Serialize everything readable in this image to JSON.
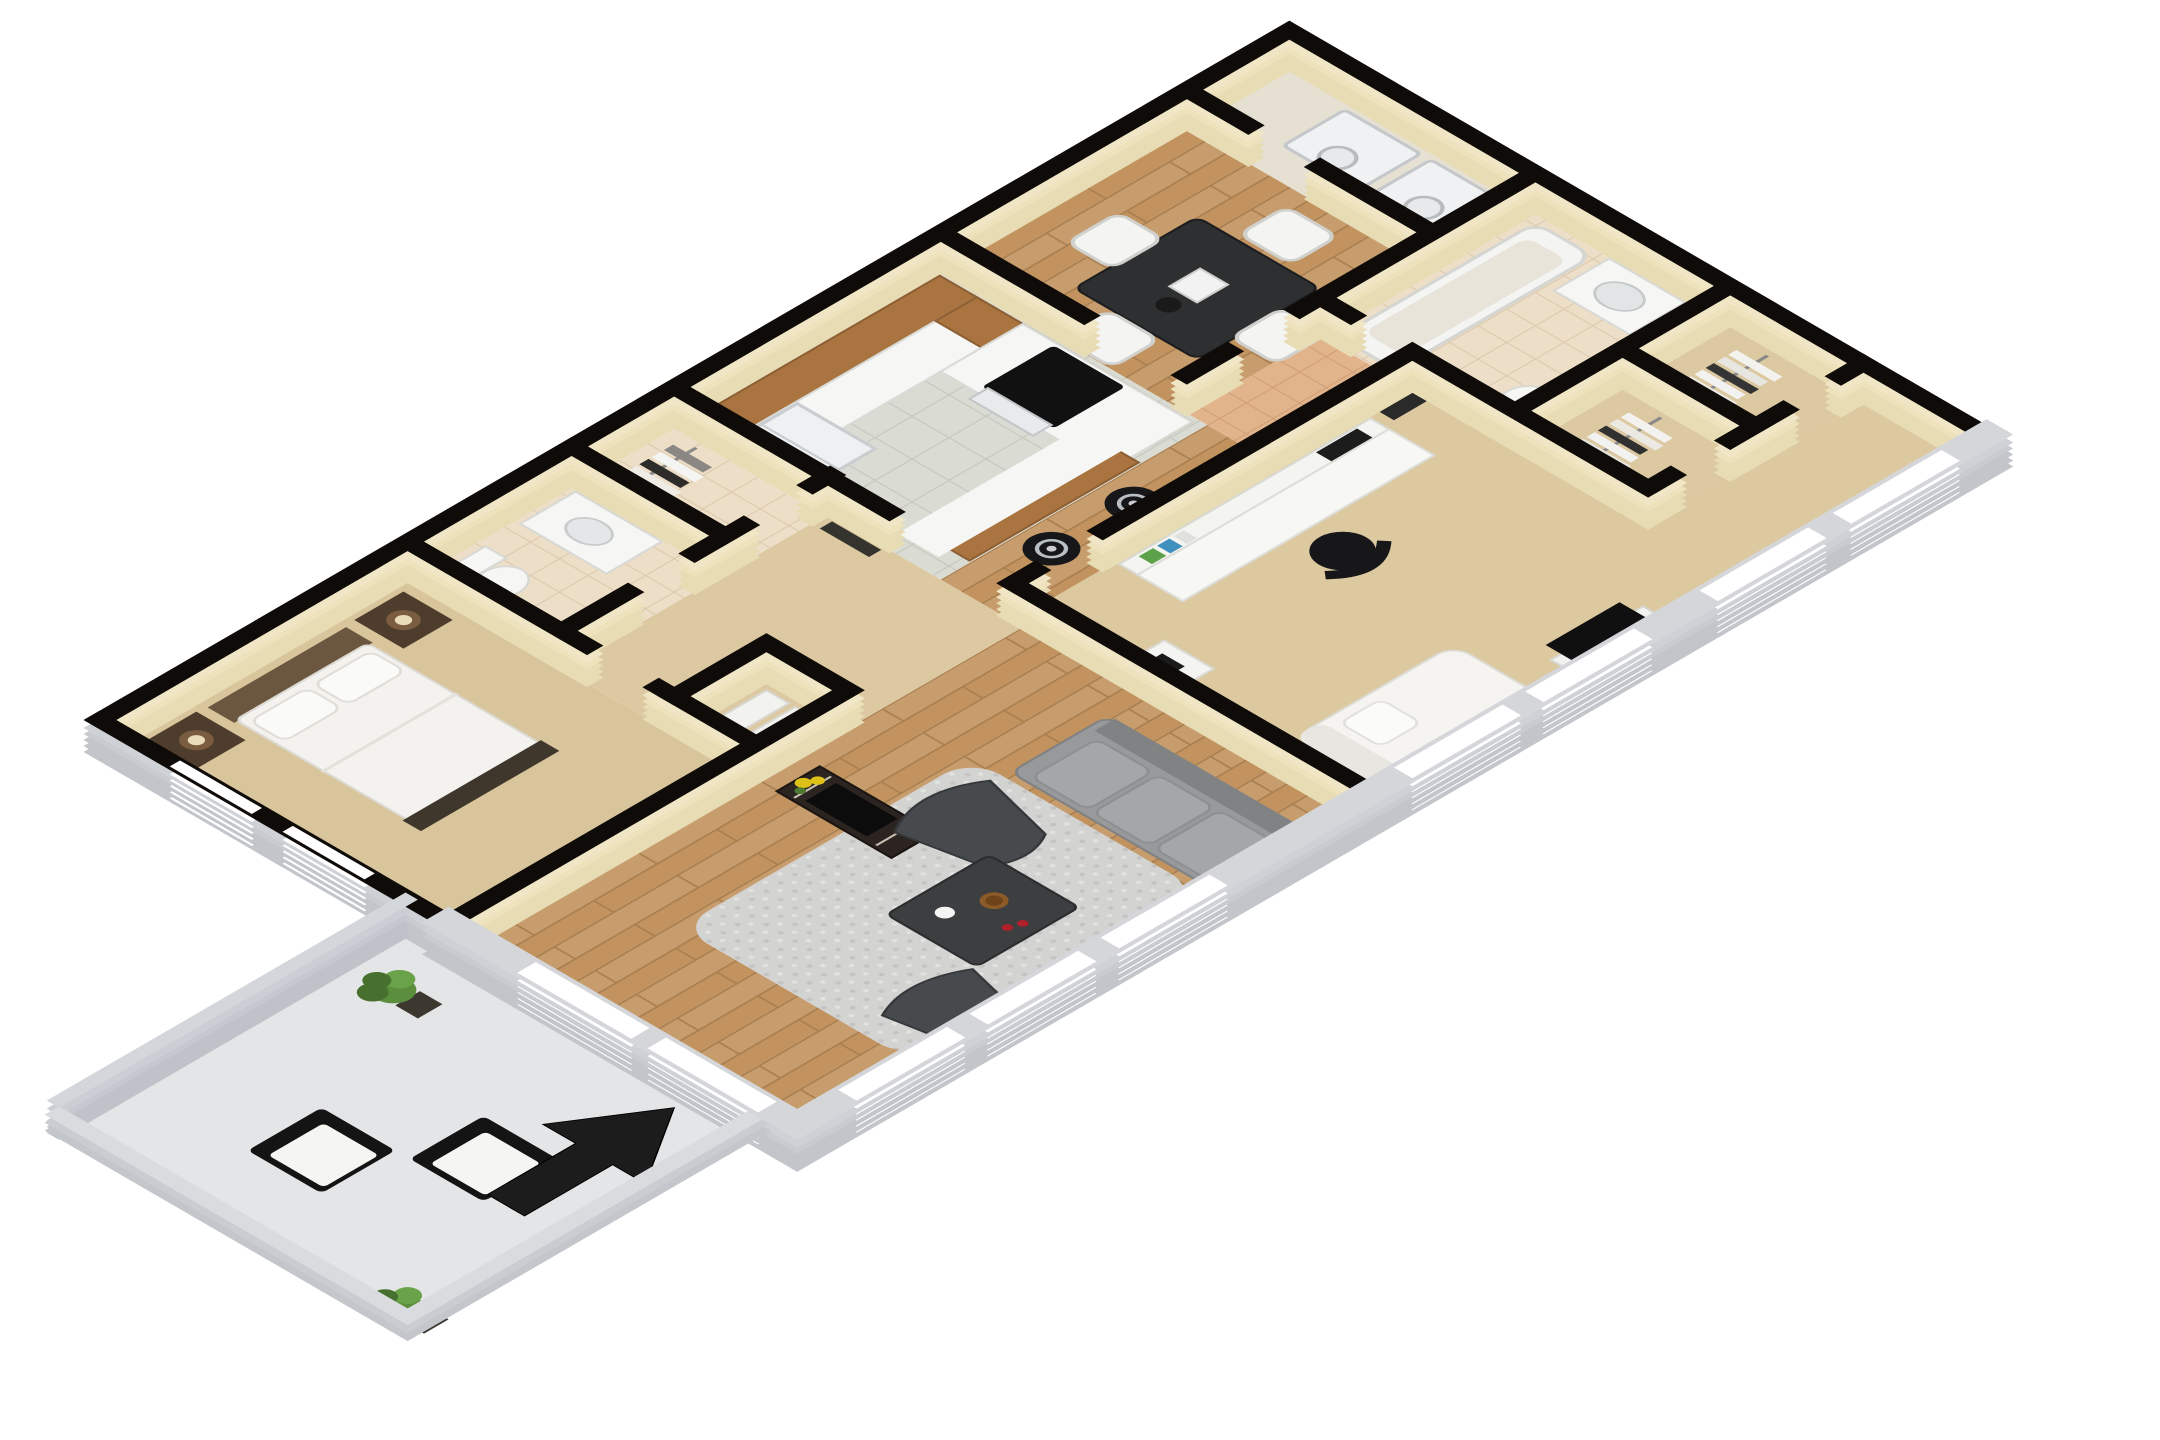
{
  "page": {
    "background": "#ffffff",
    "description": "3D isometric cutaway floor plan rendering of a two-bedroom, two-bathroom apartment with balcony, shown on a white background with thick black wall outlines",
    "visible_text": []
  },
  "palette": {
    "wall_cap": "#0e0b08",
    "wall_face": "#e7dcb4",
    "wall_face_light": "#f0e6c6",
    "exterior_cap": "#d4d6da",
    "exterior_face": "#c2c5ca",
    "parapet_cap": "#d9dbde",
    "parapet_face": "#c3c6cb",
    "privacy_cap": "#d3d6da",
    "carpet_master": "#d8c59b",
    "carpet_bedroom2": "#dcc9a0",
    "carpet_hall": "#dcc9a2",
    "wood_floor": "#c79d6e",
    "wood_line": "#a97f4f",
    "kitchen_tile": "#dadcd4",
    "kitchen_grout": "#c7cac1",
    "bath_tile": "#eddec7",
    "bath_grout": "#dcc9ad",
    "hall_tile": "#e2b48c",
    "hall_grout": "#cf9f77",
    "laundry_tile": "#e6e0d2",
    "patio_floor": "#e4e5e7",
    "rug": "#d3d3d1",
    "rug_dot_dark": "#c3c3c1",
    "rug_dot_light": "#e2e2e0",
    "sofa": "#97999b",
    "sofa_back": "#808284",
    "accent_chair": "#474a4c",
    "coffee_table": "#3c3e40",
    "black_furniture": "#17171a",
    "white_furniture": "#f5f5f2",
    "cabinet_wood": "#a9743f",
    "counter": "#f6f6f4",
    "appliance": "#eef0f1",
    "headboard": "#6b5640",
    "nightstand_dark": "#4e3c2c",
    "plant": "#5b8f3e",
    "plant_dark": "#47702e",
    "pot": "#3c3830",
    "arrow": "#1c1c1c",
    "window_frame": "#ffffff",
    "linen": "#f3f2ef",
    "decor_red": "#b0202a",
    "decor_yellow": "#ddc018",
    "book_green": "#5da24a",
    "book_blue": "#3f8fbf"
  },
  "projection": {
    "type": "isometric 3D cutaway",
    "rotate_deg": -45,
    "vertical_scale": 0.58,
    "wall_height_px": 38,
    "scale": 1.45
  },
  "rooms": [
    {
      "name": "Master Bedroom",
      "floor": "tan carpet",
      "furniture": [
        "double bed with white linens",
        "dark headboard",
        "two dark wood nightstands",
        "two table lamps",
        "framed artwork above headboard",
        "two windows on west wall",
        "closet with white shelves"
      ]
    },
    {
      "name": "Master Bathroom",
      "floor": "beige tile",
      "furniture": [
        "toilet",
        "white vanity with sink"
      ]
    },
    {
      "name": "Master Closet",
      "floor": "beige tile",
      "furniture": [
        "clothes rail with hanging clothes"
      ]
    },
    {
      "name": "Kitchen",
      "floor": "gray tile",
      "furniture": [
        "wood upper and lower cabinets",
        "white refrigerator",
        "range with black cooktop and oven",
        "white countertops",
        "breakfast bar island with white top",
        "two black and chrome bar stools"
      ]
    },
    {
      "name": "Dining Area",
      "floor": "hardwood",
      "furniture": [
        "square dark dining table",
        "four white chairs",
        "tabletop decor"
      ]
    },
    {
      "name": "Laundry Closet",
      "floor": "tile",
      "furniture": [
        "washer",
        "dryer"
      ]
    },
    {
      "name": "Second Bathroom",
      "floor": "beige tile",
      "furniture": [
        "bathtub",
        "white vanity with sink",
        "toilet"
      ]
    },
    {
      "name": "Walk-in Closet A",
      "floor": "carpet",
      "furniture": [
        "clothes rail with hanging clothes"
      ]
    },
    {
      "name": "Walk-in Closet B",
      "floor": "carpet",
      "furniture": [
        "clothes rail with hanging clothes"
      ]
    },
    {
      "name": "Living Room",
      "floor": "hardwood",
      "furniture": [
        "gray shag area rug",
        "gray sofa with cushions",
        "two dark gray accent chairs",
        "dark coffee table with cup, bowl and red decor",
        "dark media console with TV and yellow flowers",
        "framed art in hallway"
      ]
    },
    {
      "name": "Second Bedroom",
      "floor": "beige carpet",
      "furniture": [
        "white desk with hutch",
        "books",
        "black office chair",
        "white nightstand with black accessory",
        "white daybed chaise",
        "TV on white stand",
        "framed artwork",
        "windows on south wall"
      ]
    },
    {
      "name": "Balcony Patio",
      "floor": "concrete",
      "furniture": [
        "two black cube chairs with white cushions",
        "two potted green plants",
        "gray privacy wall",
        "low parapet walls",
        "large black entry arrow"
      ]
    }
  ],
  "annotations": {
    "entry_arrow_direction": "points northeast toward the apartment from the patio",
    "wall_style": "thick black caps on interior walls, light gray exterior walls with white window frames"
  }
}
